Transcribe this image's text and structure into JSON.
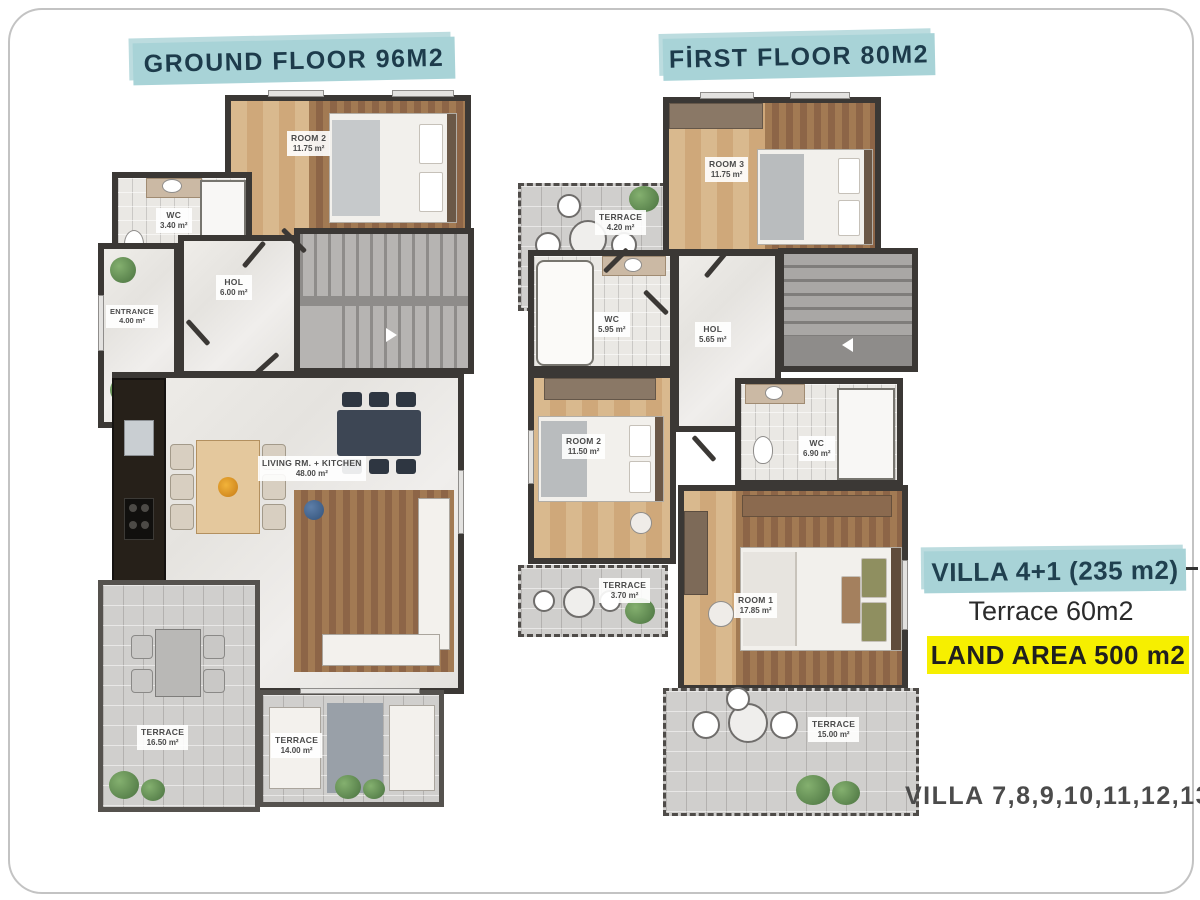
{
  "ground_floor": {
    "banner": "GROUND FLOOR 96M2",
    "rooms": {
      "room2": {
        "name": "ROOM 2",
        "area": "11.75 m²"
      },
      "wc": {
        "name": "WC",
        "area": "3.40 m²"
      },
      "entrance": {
        "name": "ENTRANCE",
        "area": "4.00 m²"
      },
      "hol": {
        "name": "HOL",
        "area": "6.00 m²"
      },
      "living": {
        "name": "LIVING RM. + KITCHEN",
        "area": "48.00 m²"
      },
      "terrace1": {
        "name": "TERRACE",
        "area": "16.50 m²"
      },
      "terrace2": {
        "name": "TERRACE",
        "area": "14.00 m²"
      }
    }
  },
  "first_floor": {
    "banner": "FİRST FLOOR 80M2",
    "rooms": {
      "terrace_top": {
        "name": "TERRACE",
        "area": "4.20 m²"
      },
      "room3": {
        "name": "ROOM 3",
        "area": "11.75 m²"
      },
      "wc_top": {
        "name": "WC",
        "area": "5.95 m²"
      },
      "hol": {
        "name": "HOL",
        "area": "5.65 m²"
      },
      "room2": {
        "name": "ROOM 2",
        "area": "11.50 m²"
      },
      "wc_mid": {
        "name": "WC",
        "area": "6.90 m²"
      },
      "terrace_small": {
        "name": "TERRACE",
        "area": "3.70 m²"
      },
      "room1": {
        "name": "ROOM 1",
        "area": "17.85 m²"
      },
      "terrace_bottom": {
        "name": "TERRACE",
        "area": "15.00 m²"
      }
    }
  },
  "annotations": {
    "villa_type": "VILLA 4+1 (235 m2)",
    "terrace_total": "Terrace 60m2",
    "land_area": "LAND AREA 500 m2",
    "villa_numbers": "VILLA 7,8,9,10,11,12,13"
  },
  "colors": {
    "banner_bg": "#a8d3d7",
    "banner_text": "#1d3b4b",
    "highlight_yellow": "#f6ef00",
    "wall": "#3b3835",
    "wood_floor": "#cfa87a",
    "terrace_tile": "#d0cfcd",
    "marble": "#eae8e5",
    "annotation_text": "#4b4b4b"
  }
}
